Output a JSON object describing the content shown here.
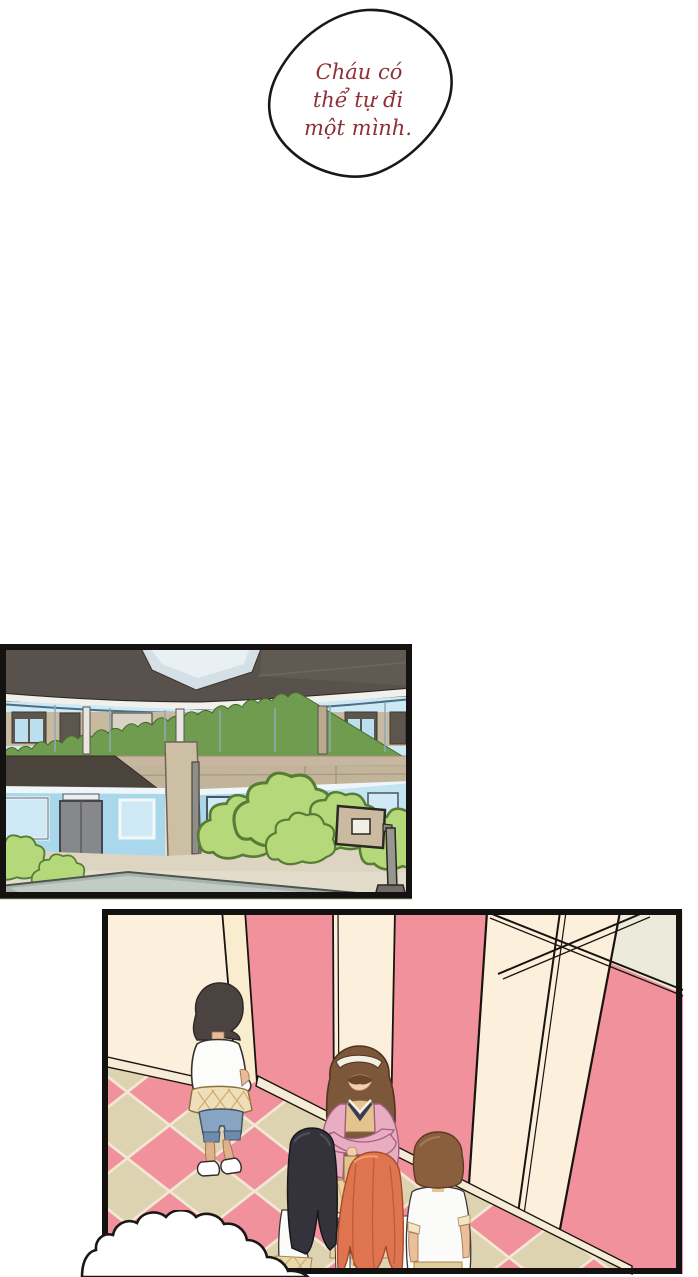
{
  "page": {
    "background": "#ffffff",
    "type": "comic-page"
  },
  "speech_bubble": {
    "lines": [
      "Cháu có",
      "thể tự đi",
      "một mình."
    ],
    "full_text": "Cháu có thể tự đi một mình.",
    "text_color": "#8e3038",
    "fill": "#ffffff",
    "outline": "#1a1816"
  },
  "panels": [
    {
      "id": "school-exterior",
      "description": "two-story school courtyard: dark roof, glass upper corridor with hedge, tan walls, blue lower walls with windows and door, bushes, basketball hoop",
      "colors": {
        "roof": "#59524c",
        "sky_notch": "#d5dfe6",
        "upper_wall": "#c2b49a",
        "glass": "#cde9f6",
        "corridor_wall": "#c8baa1",
        "hedge": "#6f9c4e",
        "lower_wall": "#a9d7ec",
        "bush": "#b5d97a",
        "ground": "#ddd4c1",
        "walkway": "#a9b3ae"
      }
    },
    {
      "id": "hallway-confrontation",
      "description": "pink hallway with cream wall panels and checkered floor; a girl stands apart at left while a teacher with crossed arms faces three students",
      "colors": {
        "wall_pink": "#f1919c",
        "wall_cream": "#fcefdb",
        "ceiling": "#ecebdb",
        "floor_tile_pink": "#f1919c",
        "floor_tile_khaki": "#ded3b1",
        "grout": "#f3e9d4"
      }
    }
  ],
  "characters": [
    {
      "id": "girl-standing",
      "hair_color": "#4a4340",
      "shirt": "#fcfcfb",
      "shorts": "#87a5c2",
      "wrap_plaid": "#eedfb8"
    },
    {
      "id": "teacher",
      "hair_color": "#7d573a",
      "headband": "#f4efe4",
      "cardigan": "#e9adc2",
      "vest": "#e4c48e"
    },
    {
      "id": "student-black-hair",
      "hair_color": "#34333b",
      "shirt": "#fbfbfa"
    },
    {
      "id": "student-orange-hair",
      "hair_color": "#df7450"
    },
    {
      "id": "student-brown-hair",
      "hair_color": "#8a5f3d",
      "shirt": "#fbfbfa"
    }
  ],
  "cloud_bubble": {
    "fill": "#ffffff",
    "outline": "#1a1816",
    "text": ""
  }
}
